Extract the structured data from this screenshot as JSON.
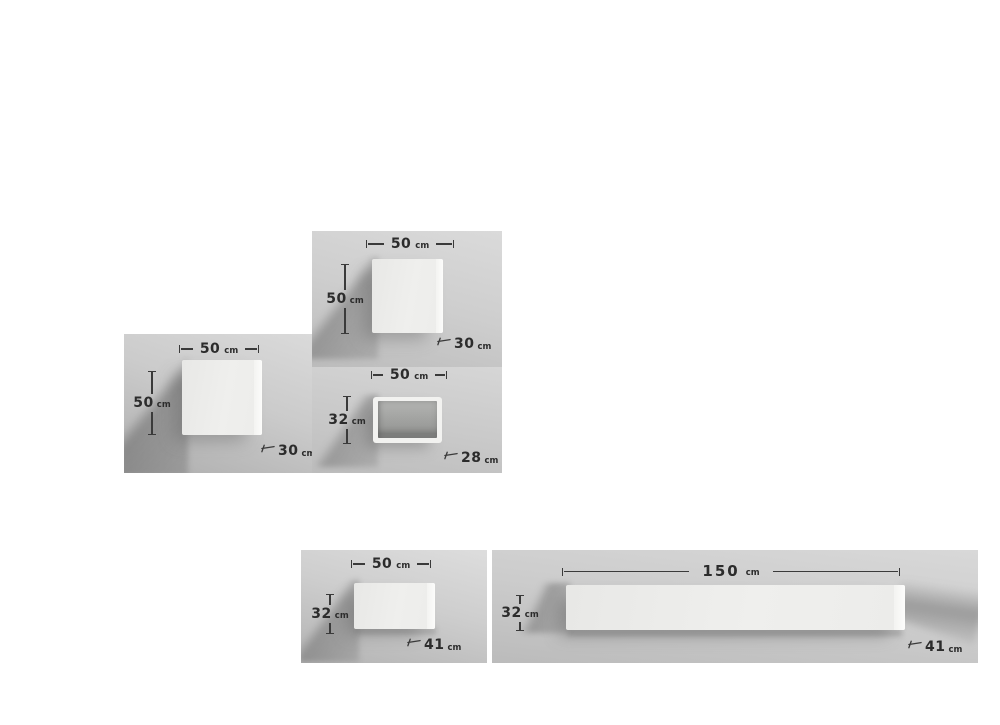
{
  "colors": {
    "page_background": "#ffffff",
    "photo_wall_gray": "#cccccc",
    "module_white": "#efefed",
    "cavity_gray": "#9b9c9a",
    "annotation_text": "#2c2c2c"
  },
  "panels": [
    {
      "name": "cube-module-top",
      "width": {
        "value": "50",
        "unit": "cm"
      },
      "height": {
        "value": "50",
        "unit": "cm"
      },
      "depth": {
        "value": "30",
        "unit": "cm"
      }
    },
    {
      "name": "cube-module-left",
      "width": {
        "value": "50",
        "unit": "cm"
      },
      "height": {
        "value": "50",
        "unit": "cm"
      },
      "depth": {
        "value": "30",
        "unit": "cm"
      }
    },
    {
      "name": "open-box-module",
      "width": {
        "value": "50",
        "unit": "cm"
      },
      "height": {
        "value": "32",
        "unit": "cm"
      },
      "depth": {
        "value": "28",
        "unit": "cm"
      }
    },
    {
      "name": "shelf-module-small",
      "width": {
        "value": "50",
        "unit": "cm"
      },
      "height": {
        "value": "32",
        "unit": "cm"
      },
      "depth": {
        "value": "41",
        "unit": "cm"
      }
    },
    {
      "name": "shelf-module-long",
      "width": {
        "value": "150",
        "unit": "cm"
      },
      "height": {
        "value": "32",
        "unit": "cm"
      },
      "depth": {
        "value": "41",
        "unit": "cm"
      }
    }
  ]
}
